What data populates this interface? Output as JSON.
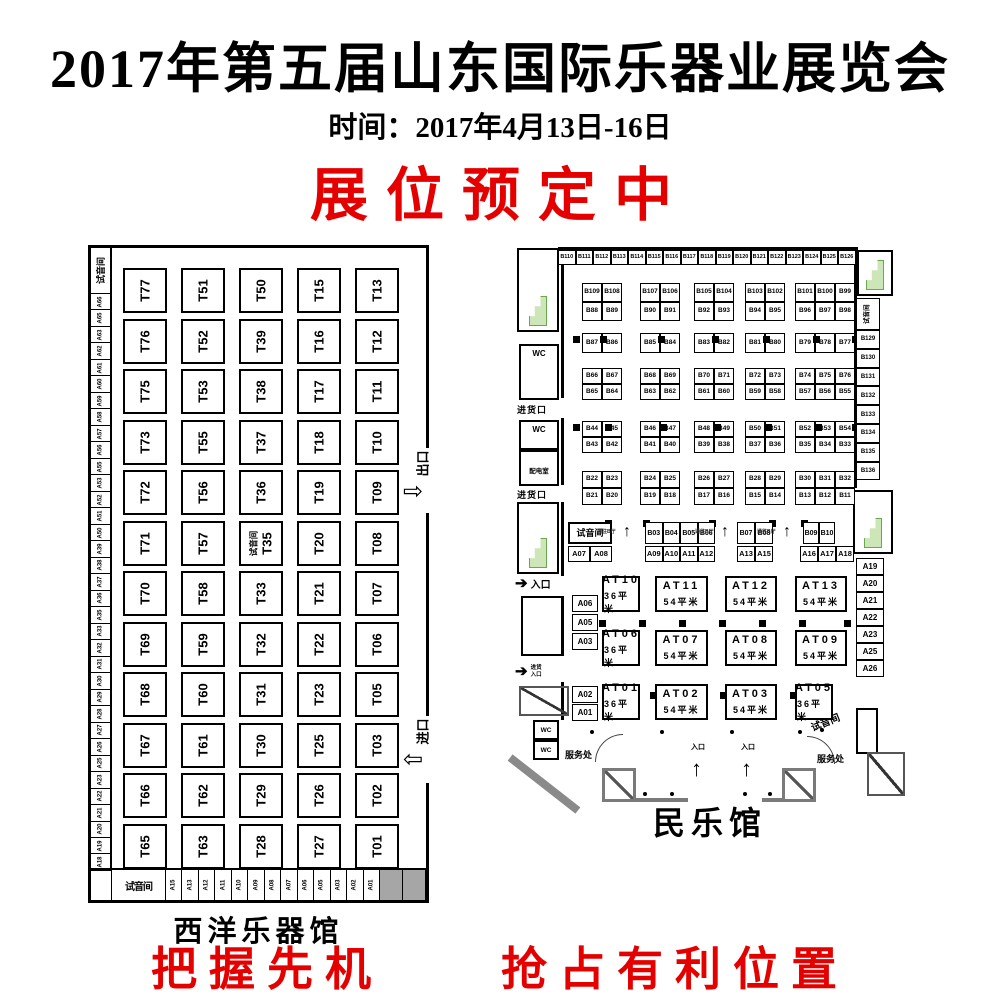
{
  "header": {
    "title": "2017年第五届山东国际乐器业展览会",
    "subtitle": "时间：2017年4月13日-16日",
    "banner": "展位预定中",
    "accent_color": "#e50000"
  },
  "west_hall": {
    "name": "西洋乐器馆",
    "listening_room": "试音间",
    "exit_label": "出口",
    "entrance_label": "进口",
    "left_strip": [
      "A66",
      "A65",
      "A63",
      "A62",
      "A61",
      "A60",
      "A59",
      "A58",
      "A57",
      "A56",
      "A55",
      "A53",
      "A52",
      "A51",
      "A50",
      "A39",
      "A38",
      "A37",
      "A36",
      "A35",
      "A33",
      "A32",
      "A31",
      "A30",
      "A29",
      "A28",
      "A27",
      "A26",
      "A25",
      "A23",
      "A22",
      "A21",
      "A20",
      "A19",
      "A18"
    ],
    "bottom_strip": [
      "A15",
      "A13",
      "A12",
      "A11",
      "A10",
      "A09",
      "A08",
      "A07",
      "A06",
      "A05",
      "A03",
      "A02",
      "A01"
    ],
    "grid_rows": [
      [
        "T77",
        "T51",
        "T50",
        "T15",
        "T13"
      ],
      [
        "T76",
        "T52",
        "T39",
        "T16",
        "T12"
      ],
      [
        "T75",
        "T53",
        "T38",
        "T17",
        "T11"
      ],
      [
        "T73",
        "T55",
        "T37",
        "T18",
        "T10"
      ],
      [
        "T72",
        "T56",
        "T36",
        "T19",
        "T09"
      ],
      [
        "T71",
        "T57",
        {
          "label": "T35",
          "note": "试音间"
        },
        "T20",
        "T08"
      ],
      [
        "T70",
        "T58",
        "T33",
        "T21",
        "T07"
      ],
      [
        "T69",
        "T59",
        "T32",
        "T22",
        "T06"
      ],
      [
        "T68",
        "T60",
        "T31",
        "T23",
        "T05"
      ],
      [
        "T67",
        "T61",
        "T30",
        "T25",
        "T03"
      ],
      [
        "T66",
        "T62",
        "T29",
        "T26",
        "T02"
      ],
      [
        "T65",
        "T63",
        "T28",
        "T27",
        "T01"
      ]
    ]
  },
  "folk_hall": {
    "name": "民乐馆",
    "top_strip": [
      "B110",
      "B111",
      "B112",
      "B113",
      "B114",
      "B115",
      "B116",
      "B117",
      "B118",
      "B119",
      "B120",
      "B121",
      "B122",
      "B123",
      "B124",
      "B125",
      "B126"
    ],
    "islands": [
      [
        [
          [
            "B109",
            "B108"
          ],
          [
            "B88",
            "B89"
          ]
        ],
        [
          [
            "B107",
            "B106"
          ],
          [
            "B90",
            "B91"
          ]
        ],
        [
          [
            "B105",
            "B104"
          ],
          [
            "B92",
            "B93"
          ]
        ],
        [
          [
            "B103",
            "B102"
          ],
          [
            "B94",
            "B95"
          ]
        ],
        [
          [
            "B101",
            "B100",
            "B99"
          ],
          [
            "B96",
            "B97",
            "B98"
          ]
        ]
      ],
      [
        [
          [
            "B87",
            "B86"
          ]
        ],
        [
          [
            "B85",
            "B84"
          ]
        ],
        [
          [
            "B83",
            "B82"
          ]
        ],
        [
          [
            "B81",
            "B80"
          ]
        ],
        [
          [
            "B79",
            "B78",
            "B77"
          ]
        ]
      ],
      [
        [
          [
            "B66",
            "B67"
          ],
          [
            "B65",
            "B64"
          ]
        ],
        [
          [
            "B68",
            "B69"
          ],
          [
            "B63",
            "B62"
          ]
        ],
        [
          [
            "B70",
            "B71"
          ],
          [
            "B61",
            "B60"
          ]
        ],
        [
          [
            "B72",
            "B73"
          ],
          [
            "B59",
            "B58"
          ]
        ],
        [
          [
            "B74",
            "B75",
            "B76"
          ],
          [
            "B57",
            "B56",
            "B55"
          ]
        ]
      ],
      [
        [
          [
            "B44",
            "B45"
          ],
          [
            "B43",
            "B42"
          ]
        ],
        [
          [
            "B46",
            "B47"
          ],
          [
            "B41",
            "B40"
          ]
        ],
        [
          [
            "B48",
            "B49"
          ],
          [
            "B39",
            "B38"
          ]
        ],
        [
          [
            "B50",
            "B51"
          ],
          [
            "B37",
            "B36"
          ]
        ],
        [
          [
            "B52",
            "B53",
            "B54"
          ],
          [
            "B35",
            "B34",
            "B33"
          ]
        ]
      ],
      [
        [
          [
            "B22",
            "B23"
          ],
          [
            "B21",
            "B20"
          ]
        ],
        [
          [
            "B24",
            "B25"
          ],
          [
            "B19",
            "B18"
          ]
        ],
        [
          [
            "B26",
            "B27"
          ],
          [
            "B17",
            "B16"
          ]
        ],
        [
          [
            "B28",
            "B29"
          ],
          [
            "B15",
            "B14"
          ]
        ],
        [
          [
            "B30",
            "B31",
            "B32"
          ],
          [
            "B13",
            "B12",
            "B11"
          ]
        ]
      ]
    ],
    "b_strip": {
      "listening_room": "试音间",
      "passage_label": "通往B厅",
      "groups": [
        [
          "B03",
          "B04",
          "B05",
          "B06"
        ],
        [
          "B07",
          "B08"
        ],
        [
          "B09",
          "B10"
        ]
      ]
    },
    "a_strip": [
      [
        "A07",
        "A08"
      ],
      [
        "A09",
        "A10",
        "A11",
        "A12"
      ],
      [
        "A13",
        "A15"
      ],
      [
        "A16",
        "A17",
        "A18"
      ]
    ],
    "right_strip": {
      "listening_room": "试音间",
      "cells": [
        "B129",
        "B130",
        "B131",
        "B132",
        "B133",
        "B134",
        "B135",
        "B136"
      ]
    },
    "right_column": [
      "A19",
      "A20",
      "A21",
      "A22",
      "A23",
      "A25",
      "A26"
    ],
    "left_column_mid": [
      "A06",
      "A05",
      "A03"
    ],
    "left_column_low": [
      "A02",
      "A01"
    ],
    "at_booths": [
      [
        {
          "id": "AT10",
          "size": "36平米"
        },
        {
          "id": "AT11",
          "size": "54平米"
        },
        {
          "id": "AT12",
          "size": "54平米"
        },
        {
          "id": "AT13",
          "size": "54平米"
        }
      ],
      [
        {
          "id": "AT06",
          "size": "36平米"
        },
        {
          "id": "AT07",
          "size": "54平米"
        },
        {
          "id": "AT08",
          "size": "54平米"
        },
        {
          "id": "AT09",
          "size": "54平米"
        }
      ],
      [
        {
          "id": "AT01",
          "size": "36平米"
        },
        {
          "id": "AT02",
          "size": "54平米"
        },
        {
          "id": "AT03",
          "size": "54平米"
        },
        {
          "id": "AT05",
          "size": "36平米"
        }
      ]
    ],
    "labels": {
      "wc": "WC",
      "power_room": "配电室",
      "goods_gate": "进货口",
      "entrance": "入口",
      "goods_entrance": "进货入口",
      "service_desk": "服务处",
      "listening_room": "试音间",
      "main_entrance": "入口"
    }
  },
  "footer": {
    "left": "把握先机",
    "right": "抢占有利位置"
  }
}
